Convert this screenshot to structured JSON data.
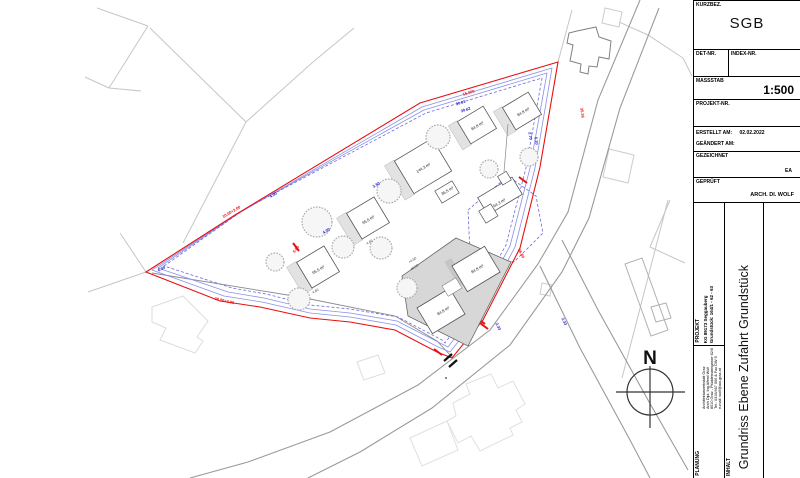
{
  "title_block": {
    "kurzbez_label": "KURZBEZ.",
    "kurzbez_value": "SGB",
    "det_nr_label": "DET-NR.",
    "index_nr_label": "INDEX-NR.",
    "massstab_label": "MASSSTAB",
    "massstab_value": "1:500",
    "projekt_nr_label": "PROJEKT-NR.",
    "erstellt_label": "ERSTELLT AM:",
    "erstellt_value": "02.02.2022",
    "geaendert_label": "GEÄNDERT AM:",
    "gezeichnet_label": "GEZEICHNET",
    "gezeichnet_value": "EA",
    "geprueft_label": "GEPRÜFT",
    "geprueft_value": "ARCH. DI. WOLF",
    "projekt_label": "PROJEKT",
    "projekt_line1": "KG 89173 Seggauberg",
    "projekt_line2": "Grundstück: 164/1 - 62 - 63",
    "planung_label": "PLANUNG",
    "planung_line1": "Architekturwerkstatt Graz",
    "planung_line2": "Arch Dipl. Ing Alfred Wolf",
    "planung_line3": "8010 Graz - Plüddemanngasse 62/6",
    "planung_line4": "Tel.: 0316/467 000 & Fax DW 5",
    "planung_line5": "e-mail: wolf@aw-graz.at",
    "inhalt_label": "INHALT",
    "inhalt_value": "Grundriss Ebene Zufahrt Grundstück"
  },
  "compass": {
    "north_label": "N"
  },
  "plan": {
    "red_dims": [
      "10.00+2.00",
      "15.000",
      "5.00",
      "35.36",
      "28.00+2.00",
      "36.80"
    ],
    "blue_dims": [
      "6.00",
      "4.00",
      "4.00",
      "3.50",
      "30.01",
      "30.62",
      "2.70",
      "5.20",
      "2.33",
      "2.33"
    ],
    "area_labels": [
      "95.5 m²",
      "95.5 m²",
      "144.3 m²",
      "36.5 m²",
      "84.8 m²",
      "84.8 m²",
      "64.3 m²",
      "84.8 m²",
      "84.8 m²"
    ],
    "level_labels": [
      "+4.50",
      "±0.00"
    ],
    "small_labels": [
      "4.60",
      "4.60"
    ]
  },
  "colors": {
    "boundary_red": "#e81010",
    "setback_blue": "#8a90e6",
    "dim_blue": "#2020c8",
    "parcel_gray": "#c6c6c6",
    "road_gray": "#9a9a9a",
    "platform_gray": "#d7d7d7"
  }
}
